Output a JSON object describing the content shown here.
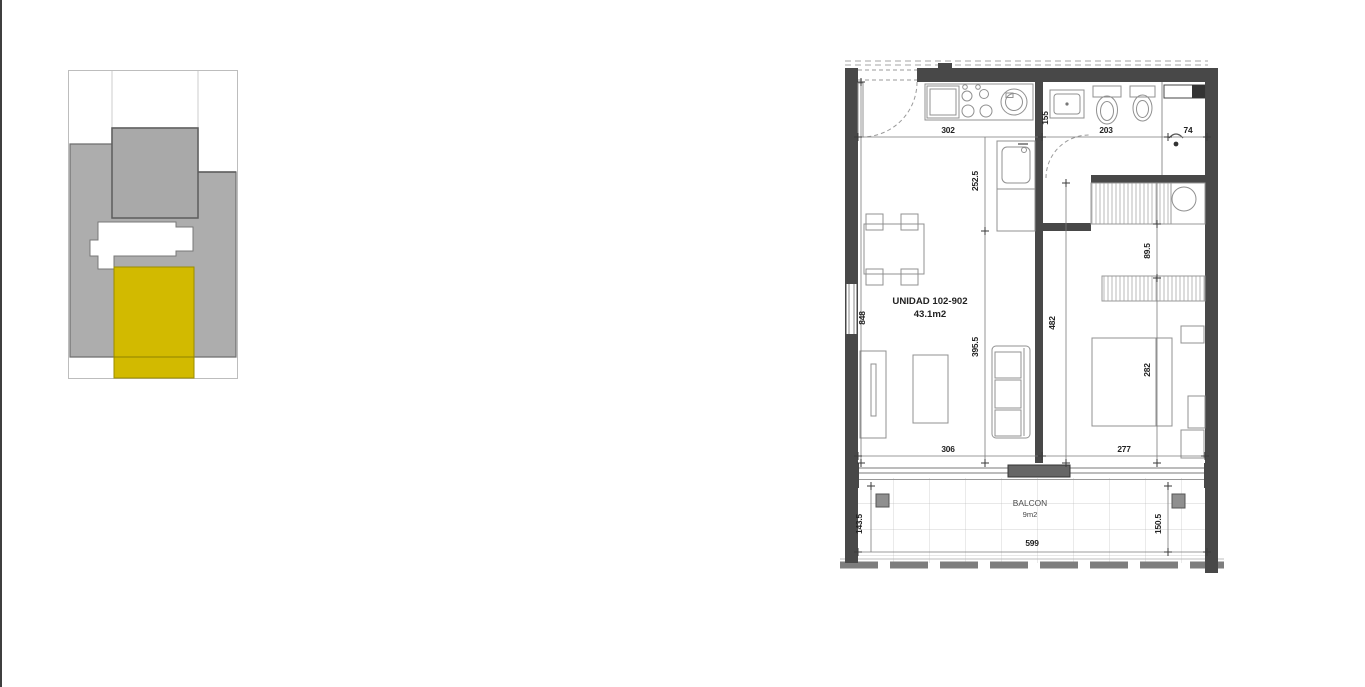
{
  "key_plan": {
    "highlight_color": "#d2ba00",
    "building_color": "#adadad"
  },
  "floor_plan": {
    "unit_label": "UNIDAD 102-902",
    "unit_area": "43.1m2",
    "balcony_label": "BALCON",
    "balcony_area": "9m2",
    "dims": {
      "d302": "302",
      "d155": "155",
      "d203": "203",
      "d74": "74",
      "d252_5": "252.5",
      "d89_5": "89.5",
      "d848": "848",
      "d395_5": "395.5",
      "d482": "482",
      "d282": "282",
      "d306": "306",
      "d277": "277",
      "d143_5": "143.5",
      "d599": "599",
      "d150_5": "150.5"
    }
  }
}
